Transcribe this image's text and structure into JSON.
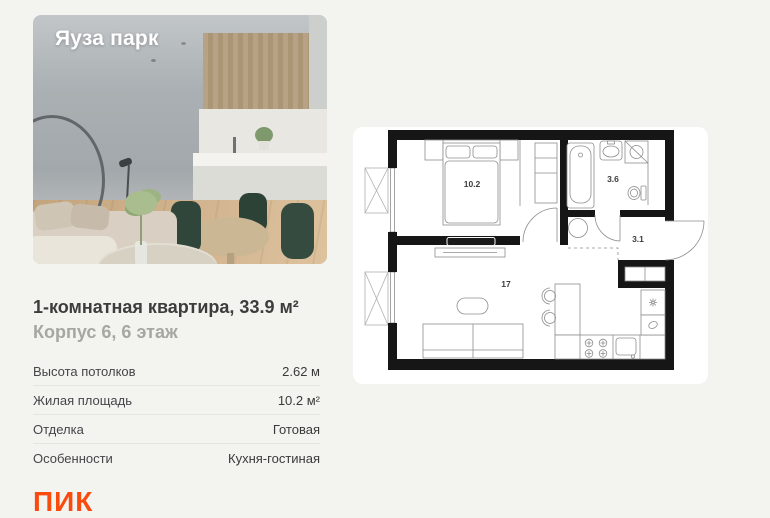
{
  "card": {
    "project_title": "Яуза парк",
    "heading": "1-комнатная квартира, 33.9 м²",
    "subheading": "Корпус 6, 6 этаж"
  },
  "details": {
    "rows": [
      {
        "label": "Высота потолков",
        "value": "2.62 м"
      },
      {
        "label": "Жилая площадь",
        "value": "10.2 м²"
      },
      {
        "label": "Отделка",
        "value": "Готовая"
      },
      {
        "label": "Особенности",
        "value": "Кухня-гостиная"
      }
    ]
  },
  "floorplan": {
    "rooms": [
      {
        "name": "bedroom",
        "label": "10.2"
      },
      {
        "name": "bathroom",
        "label": "3.6"
      },
      {
        "name": "hallway",
        "label": "3.1"
      },
      {
        "name": "kitchen-living",
        "label": "17"
      }
    ]
  },
  "brand": {
    "logo_text": "ПИК"
  },
  "colors": {
    "accent_orange": "#fa4b0f",
    "page_bg": "#f3f3f0",
    "panel_bg": "#ffffff",
    "wall": "#161616"
  }
}
